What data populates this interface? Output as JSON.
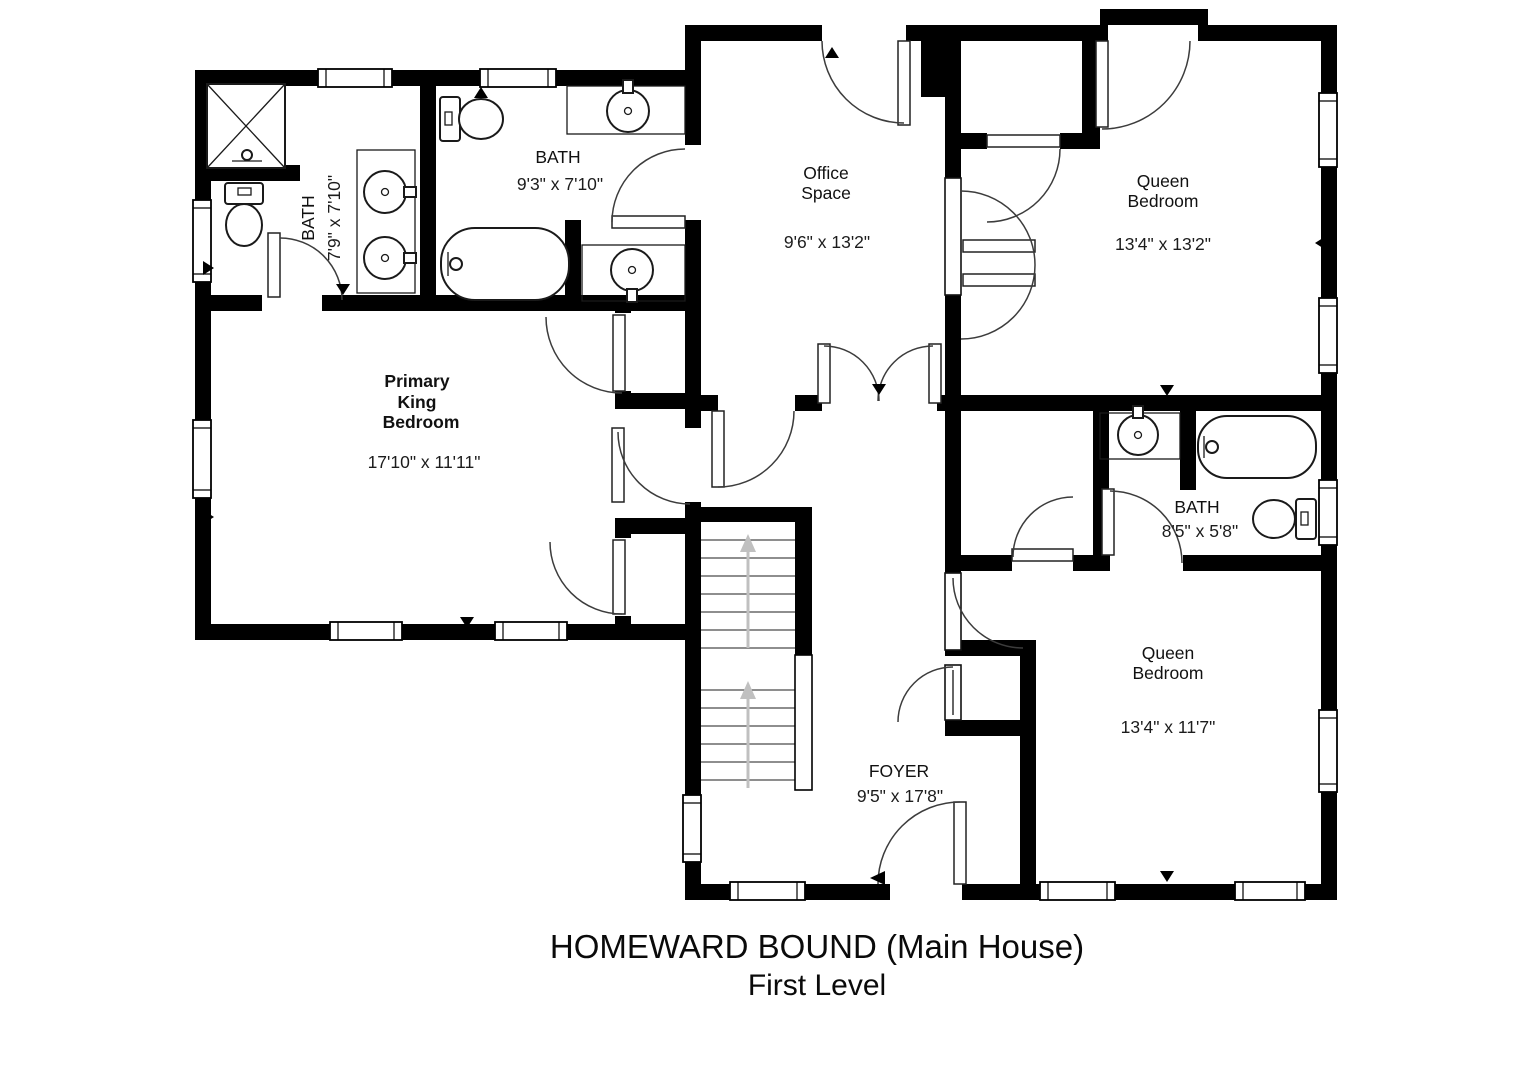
{
  "title": {
    "line1": "HOMEWARD BOUND (Main House)",
    "line2": "First Level"
  },
  "rooms": {
    "primary_bath": {
      "name": "BATH",
      "dims": "7'9\" x 7'10\""
    },
    "main_bath": {
      "name": "BATH",
      "dims": "9'3\" x 7'10\""
    },
    "office": {
      "line1": "Office",
      "line2": "Space",
      "dims": "9'6\" x 13'2\""
    },
    "queen_top": {
      "line1": "Queen",
      "line2": "Bedroom",
      "dims": "13'4\" x 13'2\""
    },
    "primary_bedroom": {
      "line1": "Primary",
      "line2": "King",
      "line3": "Bedroom",
      "dims": "17'10\" x 11'11\""
    },
    "hall_bath": {
      "name": "BATH",
      "dims": "8'5\" x 5'8\""
    },
    "queen_bottom": {
      "line1": "Queen",
      "line2": "Bedroom",
      "dims": "13'4\" x 11'7\""
    },
    "foyer": {
      "name": "FOYER",
      "dims": "9'5\" x 17'8\""
    }
  },
  "colors": {
    "wall": "#000000",
    "background": "#ffffff",
    "stair_arrow": "#c0c0c0",
    "fixture_stroke": "#1a1a1a"
  }
}
